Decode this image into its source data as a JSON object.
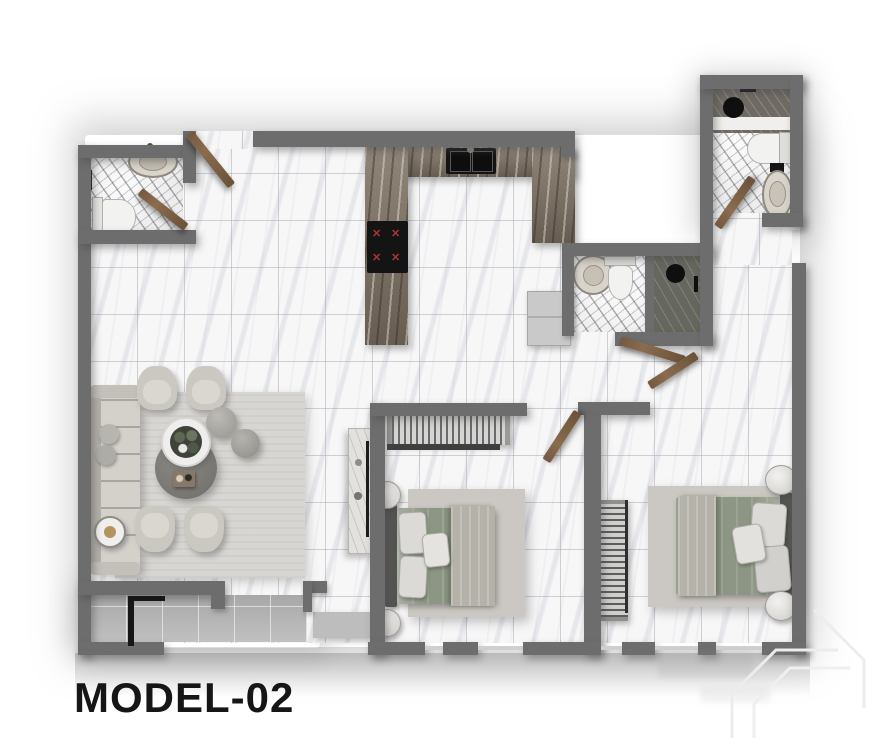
{
  "plan": {
    "model_label": "MODEL-02"
  },
  "colors": {
    "wall": "#6d6d6d",
    "floor": "#f7f7f8",
    "bath_floor": "#ededee",
    "counter": "#7d7163",
    "appliance": "#141414",
    "burner": "#a83636",
    "fridge": "#c9c9c9",
    "door": "#8a6c4e",
    "terrace": "#c2c2c2",
    "rug": "#cbc8c3",
    "living_rug": "#d8d6d2",
    "sofa": "#d4d1cb",
    "chair": "#cbc8c1",
    "mattress": "#8d9684",
    "blanket": "#b4b2a9",
    "headboard": "#575654",
    "shower_dark": "#66675e",
    "label": "#161616",
    "watermark": "#ececec"
  },
  "fixtures": {
    "burner_glyph": "✕"
  }
}
